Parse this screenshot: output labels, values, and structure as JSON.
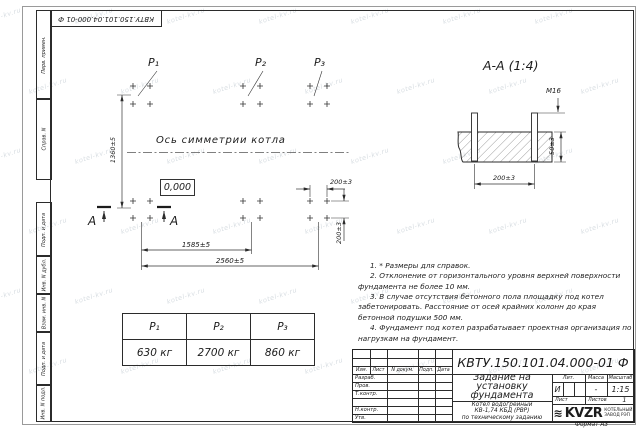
{
  "sheet": {
    "designation": "КВТУ.150.101.04.000-01 Ф",
    "format_label": "Формат А3",
    "watermark": "kotel-kv.ru"
  },
  "margin_labels": {
    "perv_primen": "Перв. примен.",
    "sprav_n": "Справ. N",
    "podp_data_1": "Подп. и дата",
    "inv_dubl": "Инв. N дубл.",
    "vzam_inv": "Взам. инв. N",
    "podp_data_2": "Подп. и дата",
    "inv_podl": "Инв. N подл."
  },
  "plan": {
    "p1_label": "P₁",
    "p2_label": "P₂",
    "p3_label": "P₃",
    "axis_label": "Ось симметрии котла",
    "level_mark": "0,000",
    "dim_height": "1360±5",
    "dim_width_inner": "1585±5",
    "dim_width_outer": "2560±5",
    "dim_pair_horizontal": "200±3",
    "dim_pair_vertical": "200±3",
    "section_letter_left": "A",
    "section_letter_right": "A"
  },
  "section": {
    "title": "А-А (1:4)",
    "thread_label": "М16",
    "dim_depth": "50±3",
    "dim_spacing": "200±3"
  },
  "load_table": {
    "headers": [
      "P₁",
      "P₂",
      "P₃"
    ],
    "values": [
      "630 кг",
      "2700 кг",
      "860 кг"
    ]
  },
  "notes": [
    "1. * Размеры для справок.",
    "2. Отклонение от горизонтального уровня верхней поверхности фундамента не более 10 мм.",
    "3. В случае отсутствия бетонного пола площадку под котел забетонировать. Расстояние от осей крайних колонн до края бетонной подушки 500 мм.",
    "4. Фундамент под котел разрабатывает проектная организация по нагрузкам на фундамент."
  ],
  "title_block": {
    "designation": "КВТУ.150.101.04.000-01 Ф",
    "doc_title_lines": [
      "Задание на",
      "установку",
      "фундамента"
    ],
    "product_lines": [
      "Котел водогрейный",
      "КВ-1,74 КБД (РВР)",
      "по техническому заданию"
    ],
    "header_cols": [
      "Изм.",
      "Лист",
      "N докум.",
      "Подп.",
      "Дата"
    ],
    "rows": [
      "Разраб.",
      "Пров.",
      "Т.контр.",
      "Н.контр.",
      "Утв."
    ],
    "lit_label": "Лит.",
    "lit_value": "И",
    "massa_label": "Масса",
    "massa_value": "-",
    "masshtab_label": "Масштаб",
    "masshtab_value": "1:15",
    "list_label": "Лист",
    "listov_label": "Листов",
    "listov_value": "1",
    "logo_text": "KVZR",
    "logo_sub_lines": [
      "КОТЕЛЬНЫЙ",
      "ЗАВОД РЭП"
    ]
  }
}
